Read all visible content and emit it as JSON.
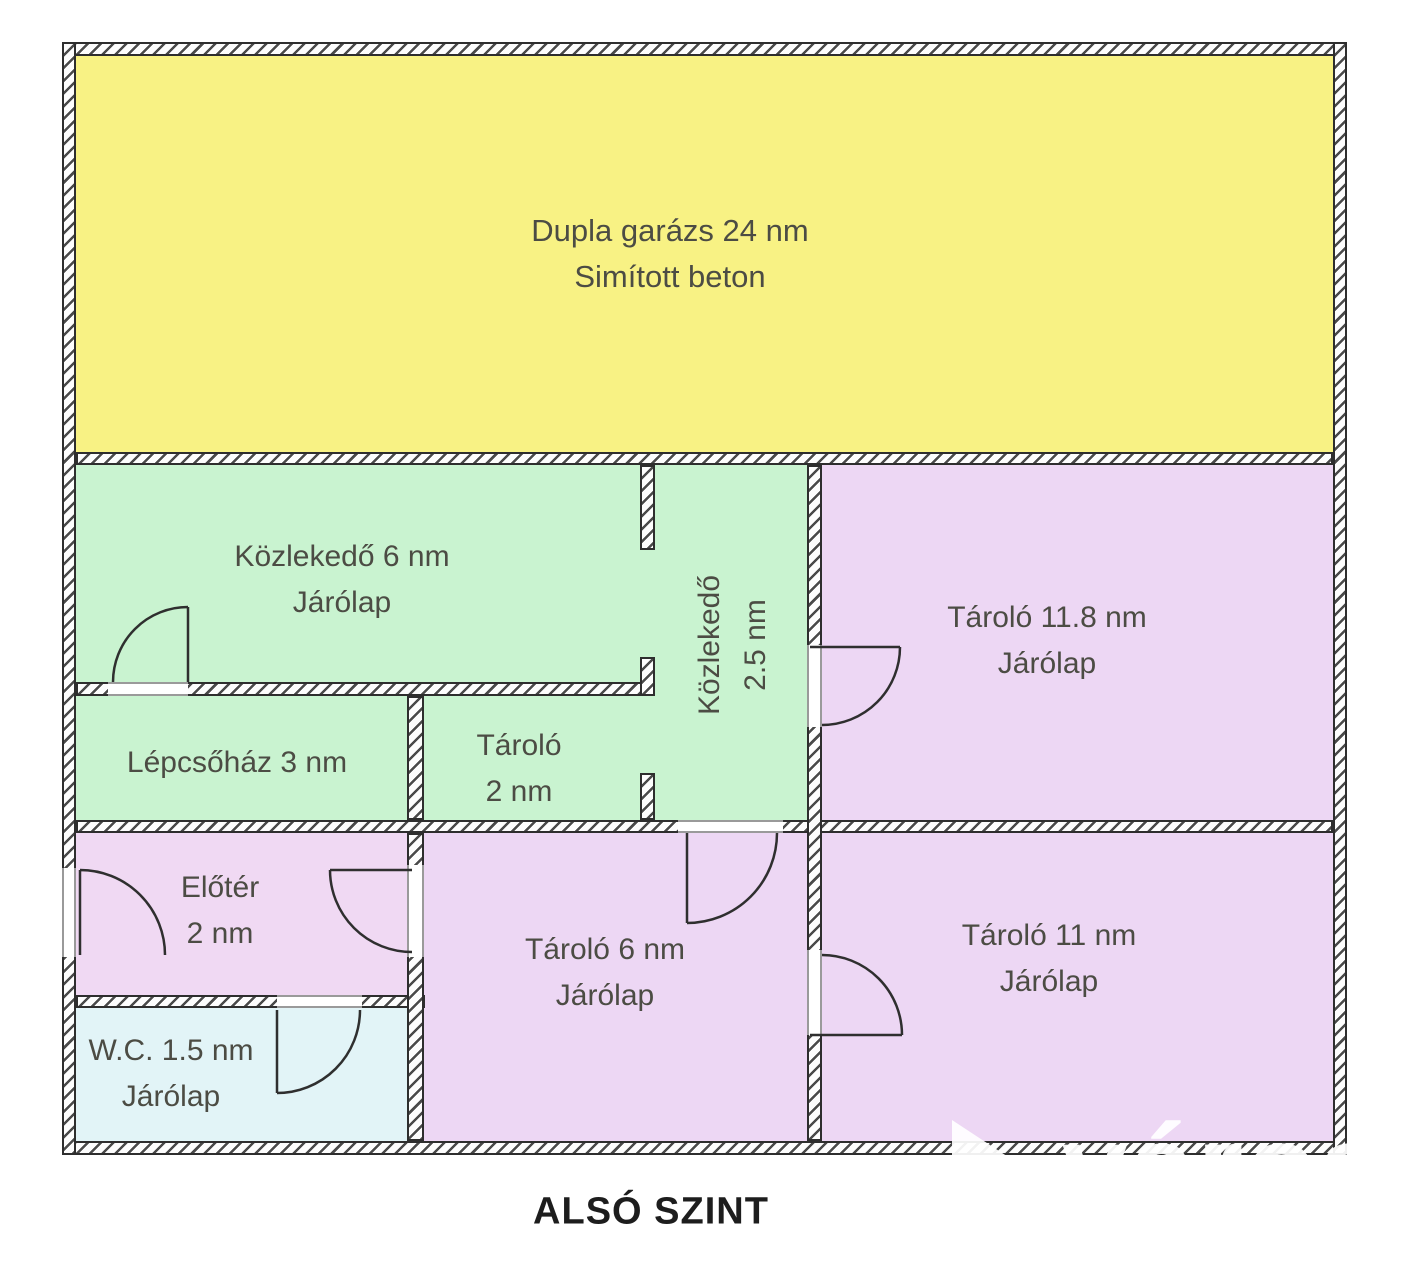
{
  "title": "ALSÓ SZINT",
  "watermark": "város",
  "rooms": {
    "garage": {
      "line1": "Dupla garázs 24 nm",
      "line2": "Simított beton"
    },
    "kozlekedo6": {
      "line1": "Közlekedő 6 nm",
      "line2": "Járólap"
    },
    "kozlekedo25": {
      "line1": "Közlekedő",
      "line2": "2.5 nm"
    },
    "tarolo118": {
      "line1": "Tároló 11.8 nm",
      "line2": "Járólap"
    },
    "lepcsohaz": {
      "line1": "Lépcsőház 3 nm"
    },
    "tarolo2": {
      "line1": "Tároló",
      "line2": "2 nm"
    },
    "eloter": {
      "line1": "Előtér",
      "line2": "2 nm"
    },
    "tarolo6": {
      "line1": "Tároló 6 nm",
      "line2": "Járólap"
    },
    "tarolo11": {
      "line1": "Tároló 11 nm",
      "line2": "Járólap"
    },
    "wc": {
      "line1": "W.C. 1.5 nm",
      "line2": "Járólap"
    }
  },
  "colors": {
    "garage_yellow": "#f8f284",
    "corridor_green": "#c9f3d0",
    "storage_purple": "#edd7f4",
    "wc_blue": "#e2f4f7",
    "wall_hatch": "#4a4a4a",
    "label_text": "#4c4c44"
  }
}
